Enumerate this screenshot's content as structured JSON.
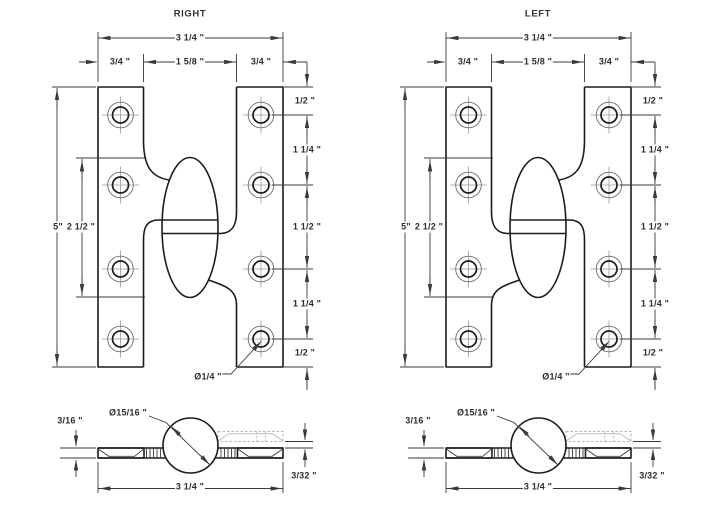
{
  "sheet": {
    "drawings": [
      {
        "title": "RIGHT",
        "handing": "right"
      },
      {
        "title": "LEFT",
        "handing": "left"
      }
    ],
    "dims": {
      "overall_width": "3 1/4 \"",
      "leaf_width": "3/4 \"",
      "knuckle_gap": "1 5/8 \"",
      "edge_offset": "1/2 \"",
      "hole_pitch_small": "1 1/4 \"",
      "hole_pitch_large": "1 1/2 \"",
      "height": "5\"",
      "knuckle_length": "2 1/2 \"",
      "screw_hole_dia": "Ø1/4 \"",
      "knuckle_dia": "Ø15/16 \"",
      "leaf_thickness": "3/16 \"",
      "leaf_clearance": "3/32 \"",
      "bottom_overall_width": "3 1/4 \""
    }
  }
}
